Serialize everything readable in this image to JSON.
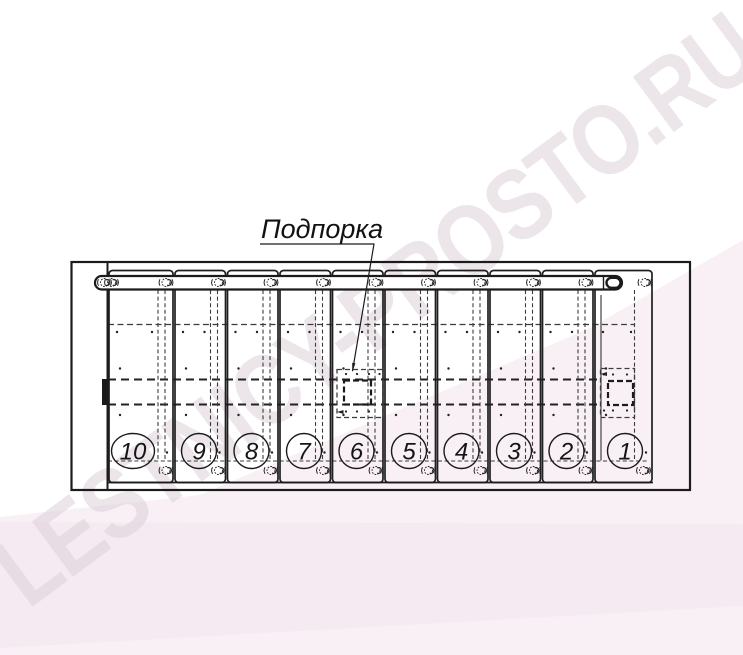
{
  "watermark": {
    "text": "LESTNICY-PROSTO.RU",
    "color": "#d9ccd6"
  },
  "callout": {
    "label": "Подпорка"
  },
  "steps": {
    "numbers": [
      "10",
      "9",
      "8",
      "7",
      "6",
      "5",
      "4",
      "3",
      "2",
      "1"
    ]
  },
  "colors": {
    "line": "#1b1b1b",
    "dashed_line": "#3c3c3c",
    "background": "#ffffff",
    "pink_light": "#f9f0f6",
    "pink_deep": "#f3e7ef"
  }
}
